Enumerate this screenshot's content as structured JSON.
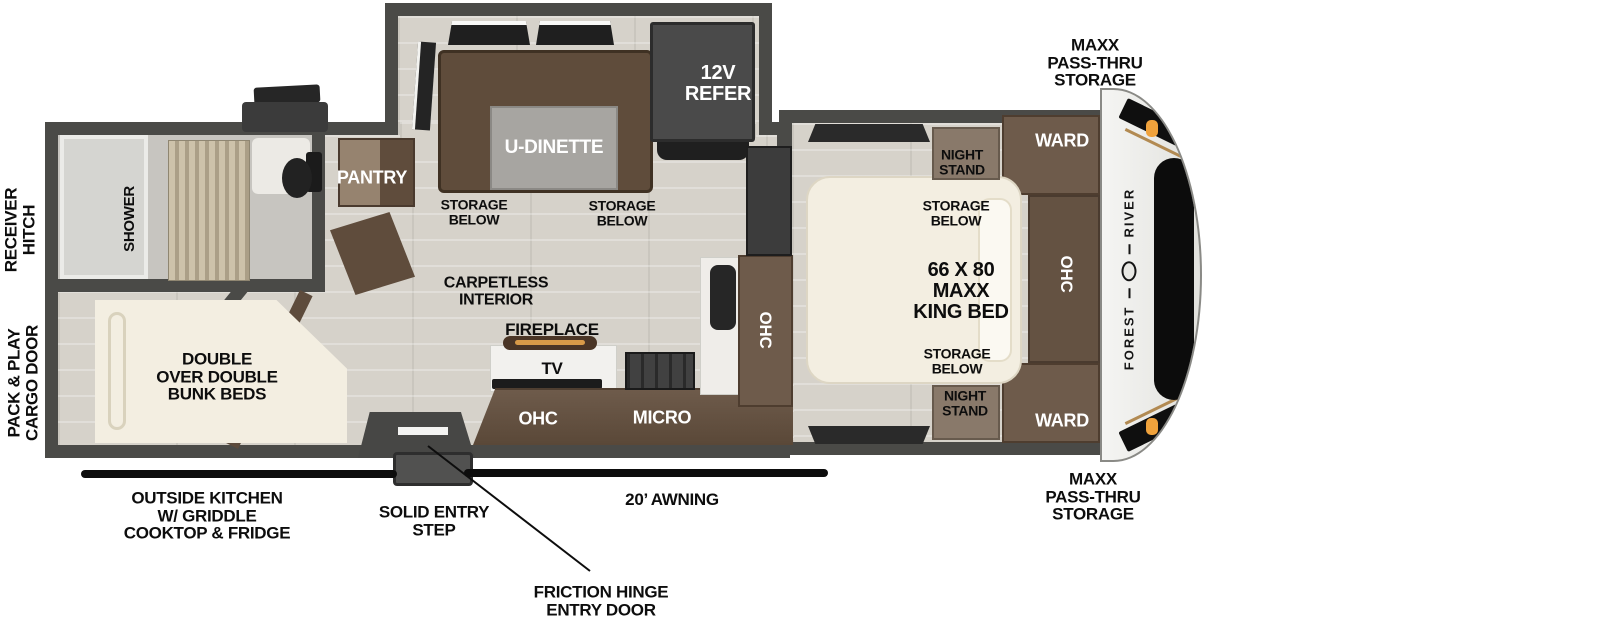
{
  "palette": {
    "wall": "#4a4a47",
    "floor_plank": "#d6d2ca",
    "cabinet_brown": "#6e5b4b",
    "dinette_brown": "#5f4c3b",
    "mattress_cream": "#f3eee1",
    "appliance_dark": "#3c3c3c",
    "marker_amber": "#f0a23c",
    "stripe_gold": "#b28a52",
    "label_black": "#0d0d0d",
    "label_white": "#ffffff"
  },
  "brand": {
    "logo_word_1": "FOREST",
    "logo_word_2": "RIVER"
  },
  "exterior_labels": {
    "receiver_hitch": "RECEIVER\nHITCH",
    "cargo_door": "PACK & PLAY\nCARGO DOOR",
    "passthru_top": "MAXX\nPASS-THRU\nSTORAGE",
    "passthru_bottom": "MAXX\nPASS-THRU\nSTORAGE",
    "outside_kitchen": "OUTSIDE KITCHEN\nW/ GRIDDLE\nCOOKTOP & FRIDGE",
    "entry_step": "SOLID ENTRY\nSTEP",
    "awning": "20’ AWNING",
    "entry_door": "FRICTION HINGE\nENTRY DOOR"
  },
  "bathroom": {
    "shower": "SHOWER"
  },
  "bunk_room": {
    "bunks": "DOUBLE\nOVER DOUBLE\nBUNK BEDS"
  },
  "galley": {
    "pantry": "PANTRY",
    "carpetless": "CARPETLESS\nINTERIOR",
    "fireplace": "FIREPLACE",
    "tv": "TV",
    "ohc": "OHC",
    "micro": "MICRO",
    "ohc_side": "OHC"
  },
  "dinette": {
    "label": "U-DINETTE",
    "refer": "12V\nREFER",
    "storage_left": "STORAGE\nBELOW",
    "storage_right": "STORAGE\nBELOW"
  },
  "bedroom": {
    "night_stand_top": "NIGHT\nSTAND",
    "night_stand_bottom": "NIGHT\nSTAND",
    "ward_top": "WARD",
    "ward_bottom": "WARD",
    "ohc": "OHC",
    "storage_top": "STORAGE\nBELOW",
    "storage_bottom": "STORAGE\nBELOW",
    "bed": "66 X 80\nMAXX\nKING BED"
  }
}
